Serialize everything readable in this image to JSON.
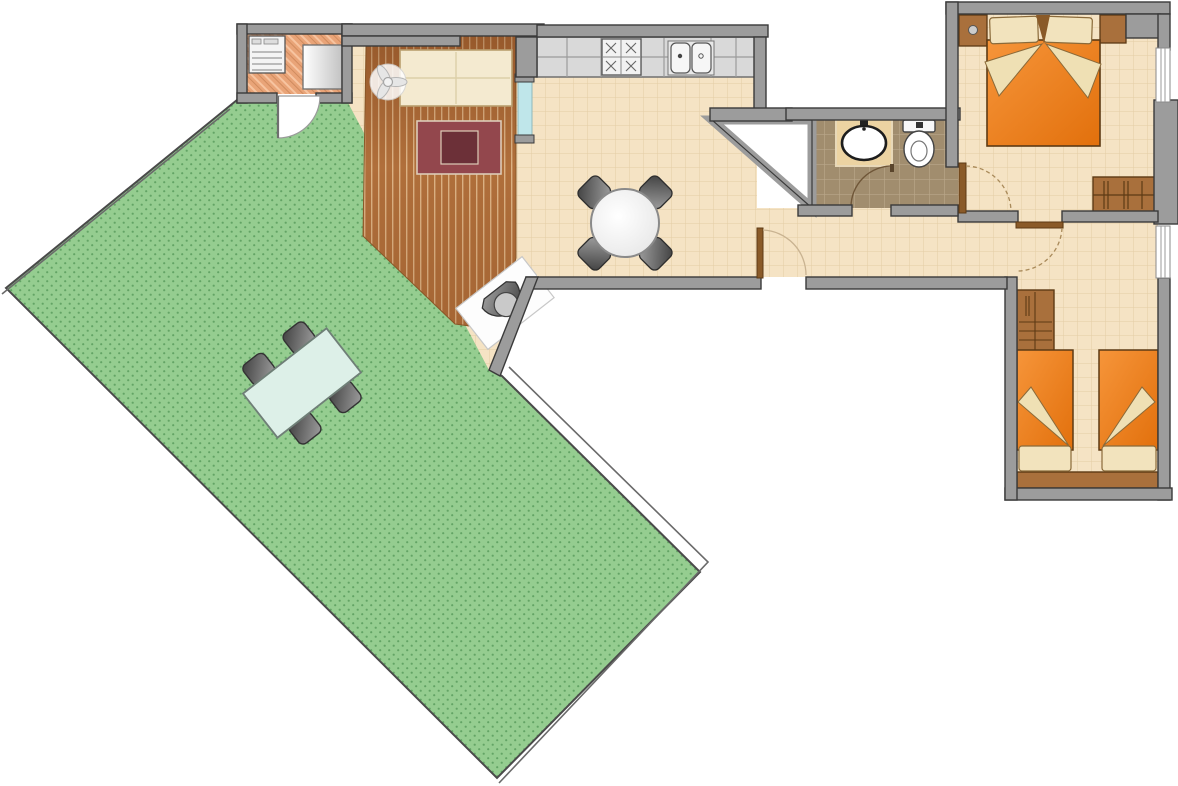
{
  "plan": {
    "type": "apartment-floor-plan",
    "rooms": [
      {
        "id": "terrace",
        "floor": "lawn-dotted-green",
        "furniture": [
          "outdoor-table",
          "outdoor-chair",
          "outdoor-chair",
          "outdoor-chair",
          "outdoor-chair"
        ]
      },
      {
        "id": "laundry",
        "floor": "terracotta-herringbone",
        "furniture": [
          "washing-machine",
          "cabinet"
        ]
      },
      {
        "id": "living-room",
        "floor": "wood-planks",
        "furniture": [
          "sofa",
          "ceiling-fan",
          "rug",
          "coffee-table",
          "armchair",
          "glass-panel"
        ]
      },
      {
        "id": "kitchen-dining",
        "floor": "beige-tile",
        "furniture": [
          "kitchen-counter",
          "stove",
          "double-sink",
          "dining-table",
          "dining-chair",
          "dining-chair",
          "dining-chair",
          "dining-chair"
        ]
      },
      {
        "id": "bathroom",
        "floor": "brown-tile",
        "furniture": [
          "vanity-sink",
          "toilet"
        ]
      },
      {
        "id": "bedroom-master",
        "floor": "beige-tile",
        "furniture": [
          "double-bed",
          "nightstand",
          "nightstand",
          "dresser",
          "ceiling-light"
        ]
      },
      {
        "id": "bedroom-twin",
        "floor": "beige-tile",
        "furniture": [
          "single-bed",
          "single-bed",
          "wardrobe",
          "headboard-bench"
        ]
      },
      {
        "id": "void-shaft",
        "floor": "none",
        "furniture": []
      }
    ],
    "doors": [
      "laundry-terrace-door",
      "entrance-door",
      "bathroom-door",
      "bedroom-master-door",
      "bedroom-twin-door"
    ],
    "windows": [
      "right-wall-window-upper",
      "right-wall-window-lower",
      "living-glass-panel"
    ],
    "colors": {
      "wall": "#9c9c9c",
      "wall_edge": "#3a3a3a",
      "floor_beige": "#f5e3c4",
      "beige_grid": "#e4cda5",
      "terrace_green": "#95cd90",
      "terrace_dot": "#63a465",
      "wood": "#b06f3b",
      "wood_gap": "#dcb284",
      "bath_tile": "#a18d6e",
      "bath_grout": "#baa78a",
      "laundry_tile": "#e9a478",
      "bed_orange_light": "#f6953a",
      "bed_orange_dark": "#e2700c",
      "bed_edge": "#5d3a14",
      "linen_cream": "#f2e3bd",
      "rug": "#93474d",
      "rug_inner": "#6c3038",
      "furniture_brown": "#a9703c",
      "counter_gray": "#d9d9d9",
      "outdoor_table": "#ddf0e8",
      "glass": "#bfe6ea",
      "door_arc": "#a98a5a"
    }
  }
}
